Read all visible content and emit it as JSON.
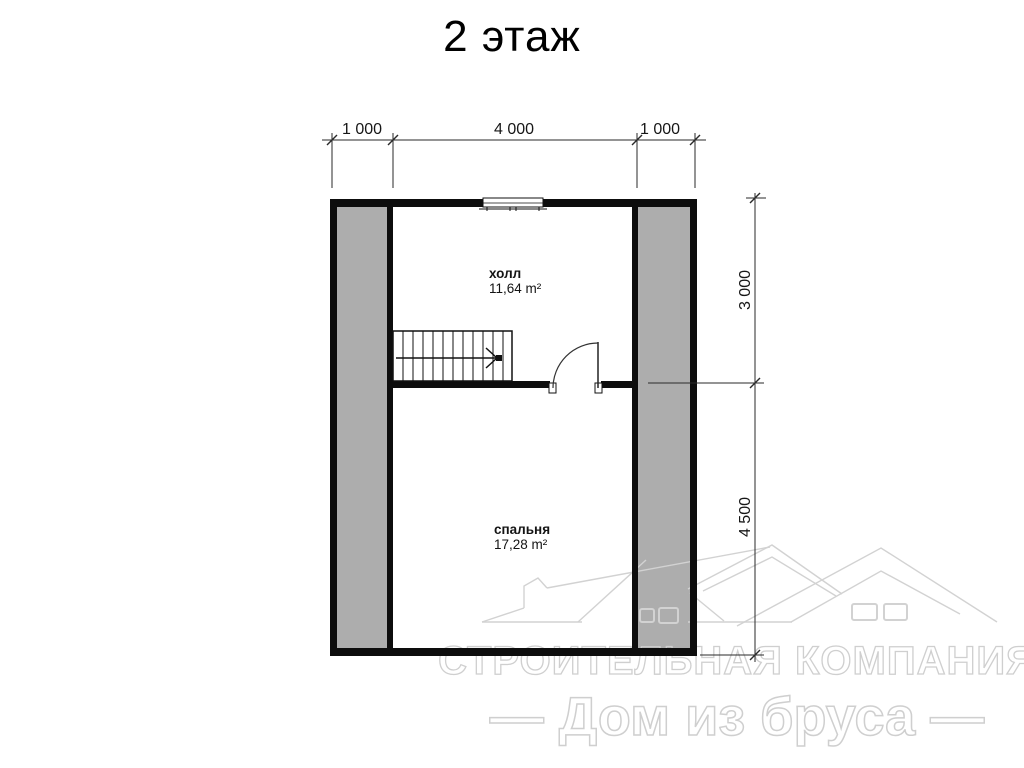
{
  "title": "2 этаж",
  "dimensions": {
    "top": [
      "1 000",
      "4 000",
      "1 000"
    ],
    "right": [
      "3 000",
      "4 500"
    ]
  },
  "plan": {
    "rooms": [
      {
        "name": "холл",
        "area": "11,64 m²"
      },
      {
        "name": "спальня",
        "area": "17,28 m²"
      }
    ]
  },
  "watermark": {
    "line1": "СТРОИТЕЛЬНАЯ КОМПАНИЯ",
    "line2": "— Дом из бруса —"
  },
  "colors": {
    "wall": "#0d0d0d",
    "shaded_zone": "#adadad",
    "dimension_line": "#2a2a2a",
    "watermark": "#d2d2d2",
    "background": "#ffffff"
  }
}
